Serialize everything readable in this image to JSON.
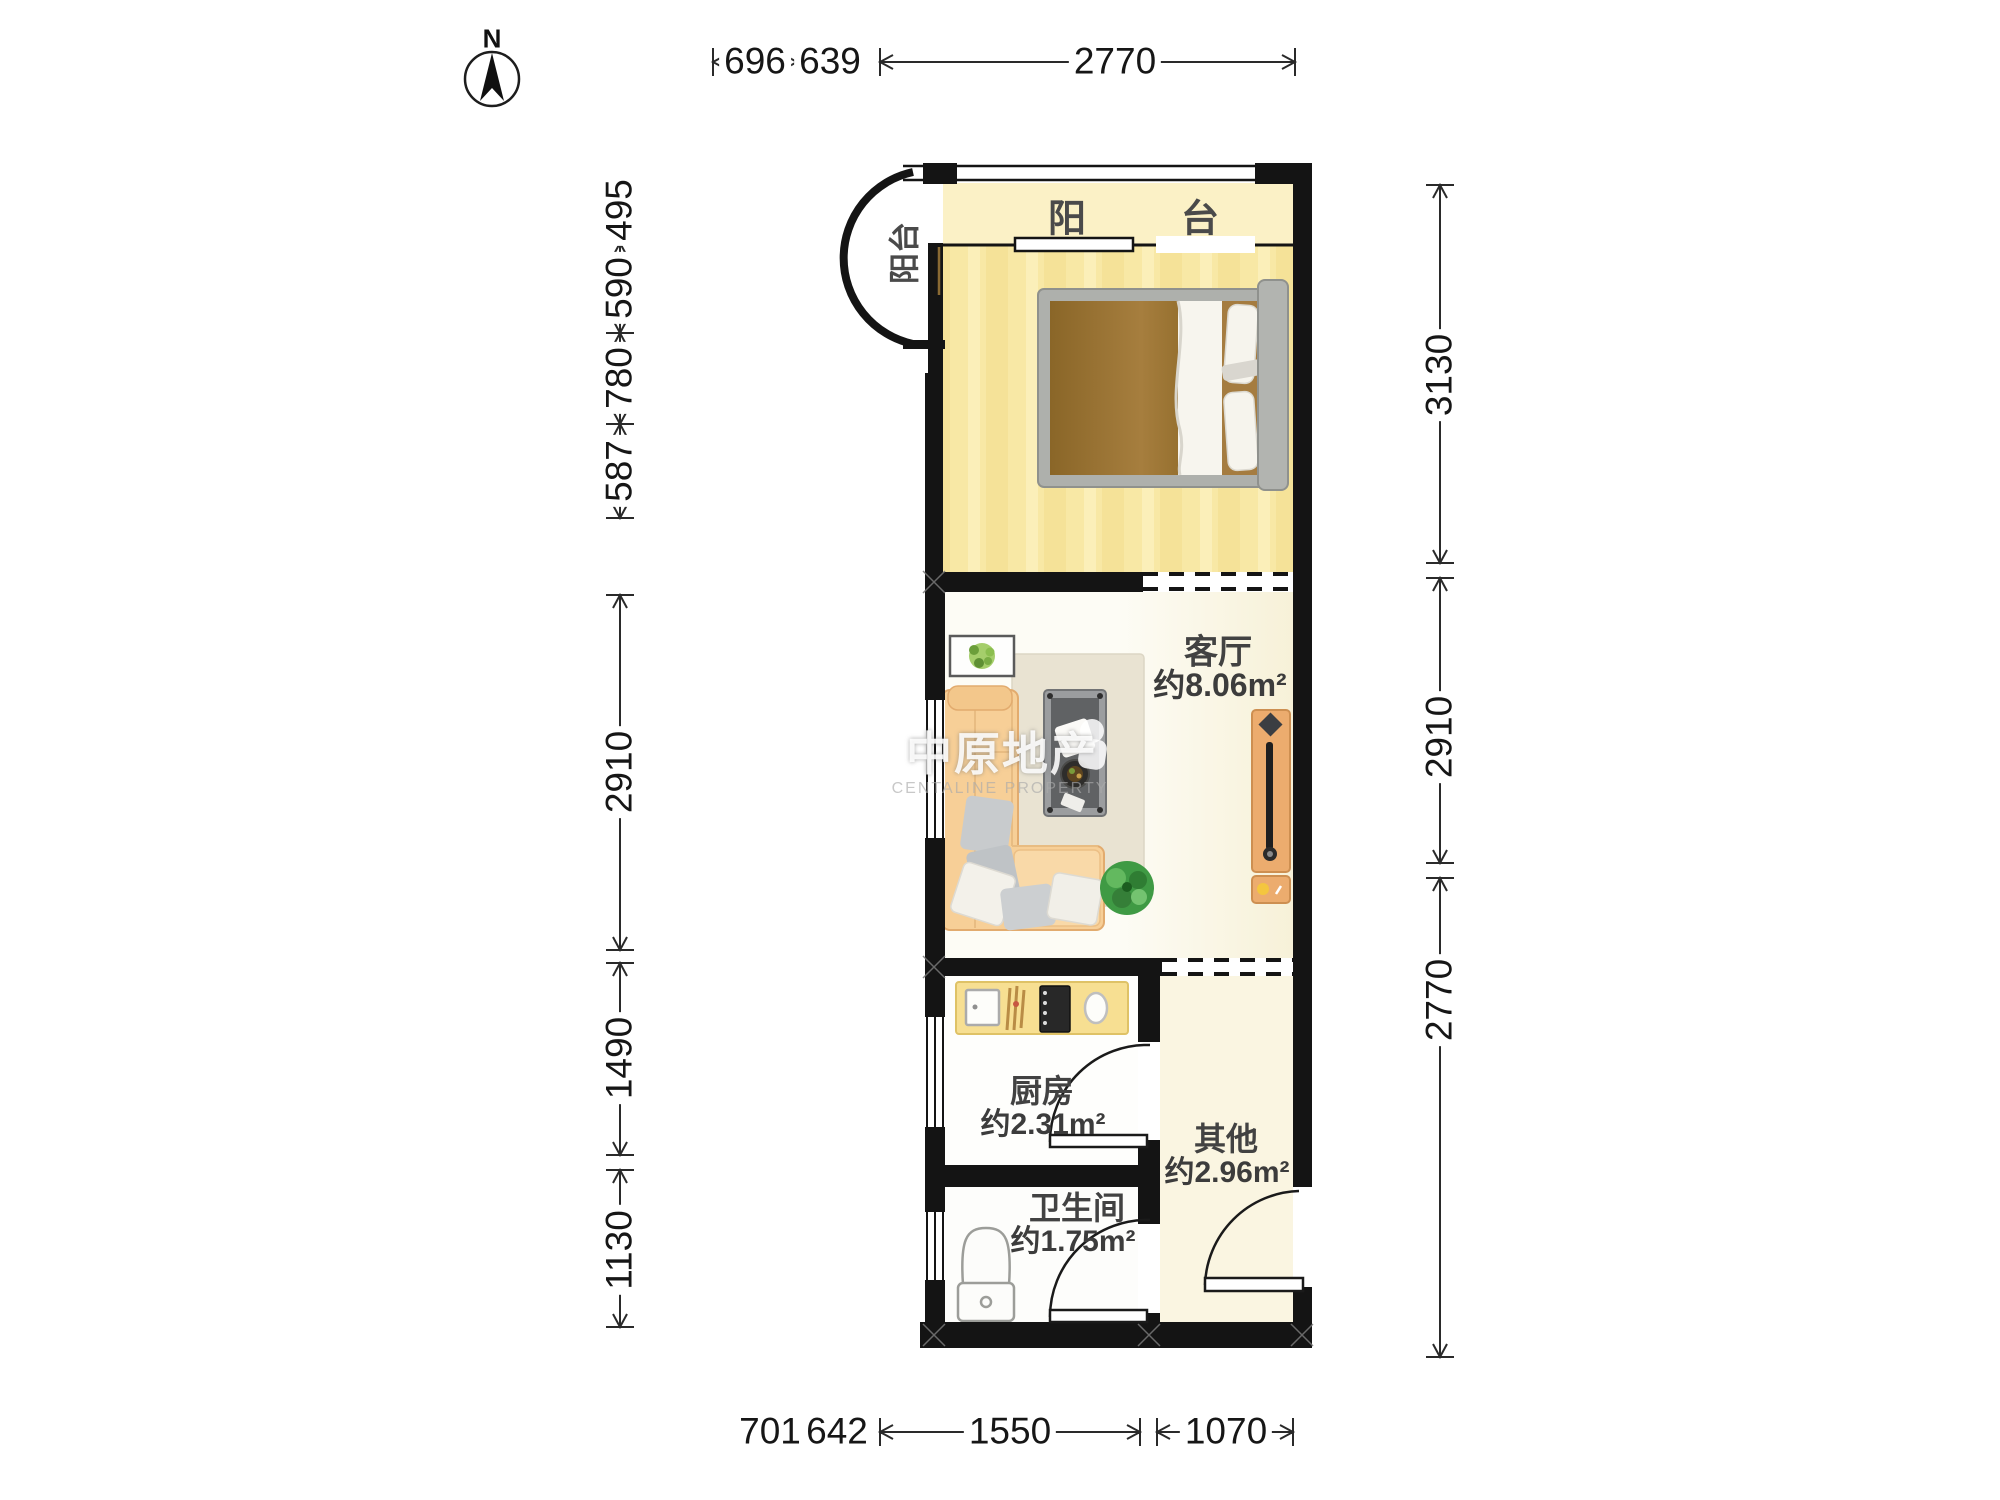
{
  "meta": {
    "compass_label": "N"
  },
  "watermark": {
    "cn": "中原地产",
    "en": "CENTALINE PROPERTY"
  },
  "rooms": {
    "balcony_top": {
      "name": "阳台"
    },
    "balcony_side": {
      "name": "阳台"
    },
    "living": {
      "name": "客厅",
      "area": "约8.06m²"
    },
    "kitchen": {
      "name": "厨房",
      "area": "约2.31m²"
    },
    "other": {
      "name": "其他",
      "area": "约2.96m²"
    },
    "bathroom": {
      "name": "卫生间",
      "area": "约1.75m²"
    }
  },
  "dimensions": {
    "top": [
      "696",
      "639",
      "2770"
    ],
    "bottom": [
      "701",
      "642",
      "1550",
      "1070"
    ],
    "left": [
      "495",
      "590",
      "780",
      "587",
      "2910",
      "1490",
      "1130"
    ],
    "right": [
      "3130",
      "2910",
      "2770"
    ]
  },
  "colors": {
    "wall": "#141414",
    "bedroom_floor": "#F8E8A5",
    "balcony_floor": "#FBF1C6",
    "other_floor": "#FAF5E1",
    "living_floor": "#FDFCF5",
    "sofa": "#F7CF97",
    "tv_cabinet": "#ECAC6E",
    "counter": "#F7DF92",
    "rug": "#E9E3D2",
    "dimension_text": "#161616"
  }
}
